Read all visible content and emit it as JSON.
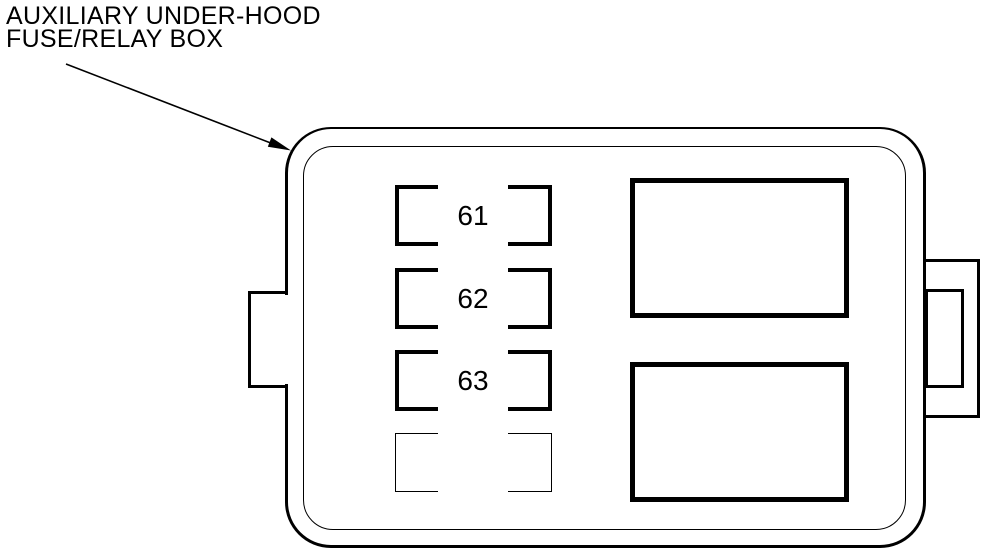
{
  "diagram": {
    "label": {
      "line1": "AUXILIARY UNDER-HOOD",
      "line2": "FUSE/RELAY BOX"
    },
    "fuse_slots": [
      {
        "number": "61",
        "occupied": true
      },
      {
        "number": "62",
        "occupied": true
      },
      {
        "number": "63",
        "occupied": true
      },
      {
        "number": "",
        "occupied": false
      }
    ],
    "relay_slots": [
      {
        "position": "top"
      },
      {
        "position": "bottom"
      }
    ],
    "colors": {
      "line": "#000000",
      "background": "#ffffff"
    }
  }
}
